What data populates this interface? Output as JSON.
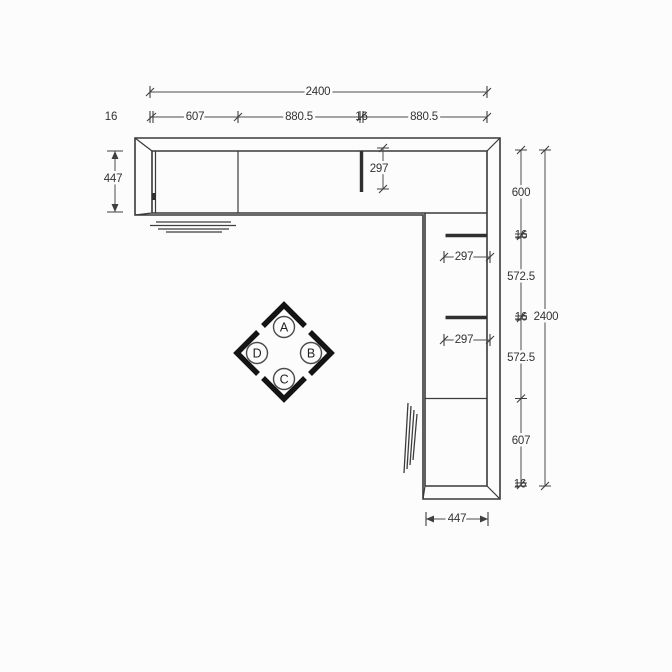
{
  "drawing": {
    "type": "corner-cabinet-plan-view",
    "background_color": "#fcfcfc",
    "line_color": "#3a3a3a",
    "dim_line_color": "#4d4d4d",
    "text_color": "#333333",
    "marker_arrow_color": "#141414"
  },
  "dimensions": {
    "top_total": "2400",
    "top_chain": [
      "16",
      "607",
      "880.5",
      "16",
      "880.5"
    ],
    "left_depth": "447",
    "top_partition_depth": "297",
    "right_chain": [
      "600",
      "16",
      "572.5",
      "16",
      "572.5",
      "607",
      "16"
    ],
    "right_total": "2400",
    "shelf_depths": [
      "297",
      "297"
    ],
    "bottom_depth": "447"
  },
  "view_markers": {
    "top": "A",
    "right": "B",
    "bottom": "C",
    "left": "D"
  }
}
